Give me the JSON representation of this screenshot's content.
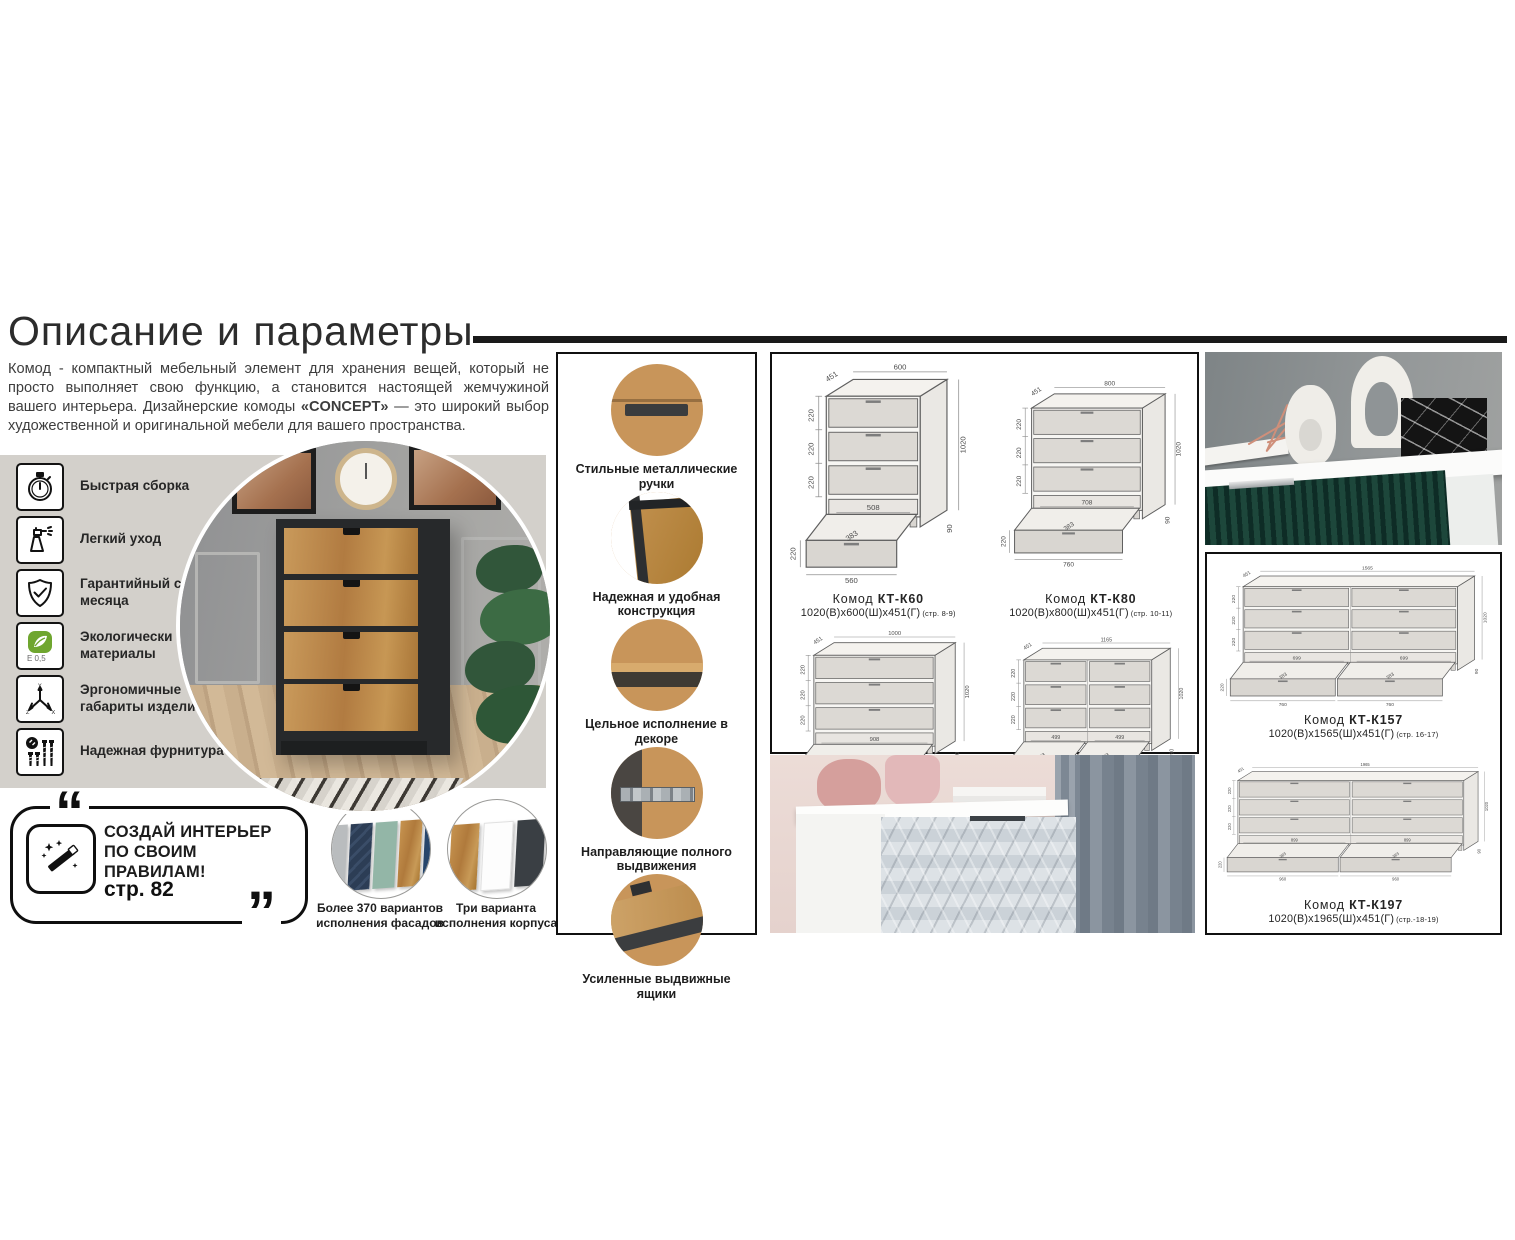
{
  "page": {
    "title": "Описание и параметры",
    "intro_1": "Комод - компактный мебельный элемент для хранения вещей, который не просто выполняет свою функцию, а становится настоящей жемчужиной вашего интерьера. Дизайнерские комоды ",
    "intro_bold": "«CONCEPT»",
    "intro_2": " — это широкий выбор художественной и оригинальной мебели для вашего пространства."
  },
  "features": [
    {
      "icon": "stopwatch-icon",
      "label": "Быстрая сборка"
    },
    {
      "icon": "spray-bottle-icon",
      "label": "Легкий уход"
    },
    {
      "icon": "shield-check-icon",
      "label": "Гарантийный срок 24 месяца"
    },
    {
      "icon": "eco-leaf-icon",
      "label": "Экологически чистые материалы"
    },
    {
      "icon": "xyz-axes-icon",
      "label": "Эргономичные габариты изделий"
    },
    {
      "icon": "screws-icon",
      "label": "Надежная фурнитура"
    }
  ],
  "promo": {
    "line": "СОЗДАЙ ИНТЕРЬЕР ПО СВОИМ ПРАВИЛАМ!",
    "page_ref": "стр. 82",
    "icon": "magic-wand-icon"
  },
  "variants": [
    {
      "label": "Более 370 вариантов исполнения фасадов"
    },
    {
      "label": "Три варианта исполнения корпуса"
    }
  ],
  "callouts": [
    {
      "label": "Стильные металлические ручки"
    },
    {
      "label": "Надежная и удобная конструкция"
    },
    {
      "label": "Цельное исполнение в декоре"
    },
    {
      "label": "Направляющие полного выдвижения"
    },
    {
      "label": "Усиленные выдвижные ящики"
    }
  ],
  "products": [
    {
      "name_prefix": "Комод",
      "model": "КТ-К60",
      "dims": "1020(В)x600(Ш)x451(Г)",
      "pages": "(стр. 8-9)",
      "drawing": {
        "w": 56,
        "cols": 1,
        "top": "600",
        "depth": "451",
        "row": "220",
        "height": "1020",
        "inner": [
          "508"
        ],
        "dw": [
          "560"
        ],
        "diag": "383",
        "dh": "220",
        "base": "90"
      }
    },
    {
      "name_prefix": "Комод",
      "model": "КТ-К80",
      "dims": "1020(В)x800(Ш)x451(Г)",
      "pages": "(стр. 10-11)",
      "drawing": {
        "w": 78,
        "cols": 1,
        "top": "800",
        "depth": "451",
        "row": "220",
        "height": "1020",
        "inner": [
          "708"
        ],
        "dw": [
          "760"
        ],
        "diag": "383",
        "dh": "220",
        "base": "90"
      }
    },
    {
      "name_prefix": "Комод",
      "model": "КТ-К100",
      "dims": "1020(В)x1000(Ш)x451(Г)",
      "pages": "(стр. 12-13)",
      "drawing": {
        "w": 96,
        "cols": 1,
        "top": "1000",
        "depth": "451",
        "row": "220",
        "height": "1020",
        "inner": [
          "908"
        ],
        "dw": [
          "960"
        ],
        "diag": "383",
        "dh": "220",
        "base": "90"
      }
    },
    {
      "name_prefix": "Комод",
      "model": "КТ-К117",
      "dims": "1020(В)x1165(Ш)x451(Г)",
      "pages": "(стр. 14-15)",
      "drawing": {
        "w": 110,
        "cols": 2,
        "top": "1165",
        "depth": "451",
        "row": "220",
        "height": "1020",
        "inner": [
          "499",
          "499"
        ],
        "dw": [
          "560",
          "560"
        ],
        "diag": "383",
        "dh": "220",
        "base": "90"
      }
    },
    {
      "name_prefix": "Комод",
      "model": "КТ-К157",
      "dims": "1020(В)x1565(Ш)x451(Г)",
      "pages": "(стр. 16-17)",
      "drawing": {
        "w": 200,
        "cols": 2,
        "top": "1565",
        "depth": "451",
        "row": "220",
        "height": "1020",
        "inner": [
          "699",
          "699"
        ],
        "dw": [
          "760",
          "760"
        ],
        "diag": "383",
        "dh": "220",
        "base": "90"
      }
    },
    {
      "name_prefix": "Комод",
      "model": "КТ-К197",
      "dims": "1020(В)x1965(Ш)x451(Г)",
      "pages": "(стр.-18-19)",
      "drawing": {
        "w": 252,
        "cols": 2,
        "top": "1965",
        "depth": "451",
        "row": "220",
        "height": "1020",
        "inner": [
          "899",
          "899"
        ],
        "dw": [
          "960",
          "960"
        ],
        "diag": "383",
        "dh": "220",
        "base": "90"
      }
    }
  ]
}
